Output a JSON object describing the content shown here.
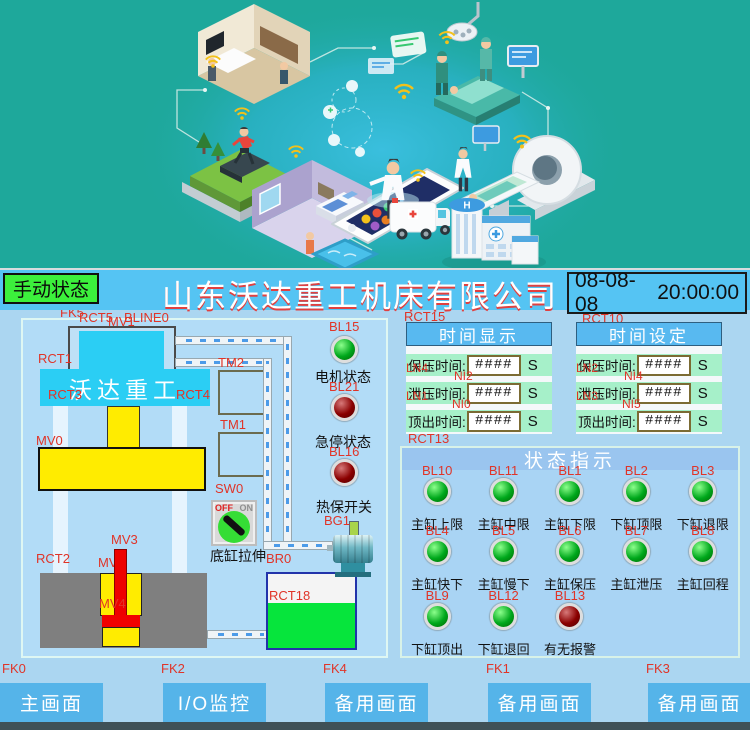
{
  "header": {
    "mode_button": "手动状态",
    "title": "山东沃达重工机床有限公司",
    "date": "08-08-08",
    "time": "20:00:00"
  },
  "illustration": {
    "helipad_letter": "H"
  },
  "machine": {
    "brand": "沃达重工",
    "switch_off": "OFF",
    "switch_on": "ON",
    "labels": {
      "motor_status": "电机状态",
      "estop_status": "急停状态",
      "thermal_switch": "热保开关",
      "bottom_cylinder": "底缸拉伸"
    },
    "leds": {
      "bl15": "green",
      "bl21": "red",
      "bl16": "red"
    },
    "tags": {
      "fk5": "FK5",
      "rct5": "RCT5",
      "mv1": "MV1",
      "bline0": "BLINE0",
      "rct1": "RCT1",
      "tm2": "TM2",
      "rct3": "RCT3",
      "rct4": "RCT4",
      "tm1": "TM1",
      "mv0": "MV0",
      "sw0": "SW0",
      "mv3": "MV3",
      "rct2": "RCT2",
      "mv2": "MV2",
      "mv4": "MV4",
      "br0": "BR0",
      "bg1": "BG1",
      "rct18": "RCT18",
      "bl15": "BL15",
      "bl21": "BL21",
      "bl16": "BL16",
      "rct15": "RCT15",
      "rct10": "RCT10"
    }
  },
  "time_display": {
    "title": "时间显示",
    "rows": [
      {
        "label": "保压时间:",
        "value": "####",
        "unit": "S",
        "tag_left": "LN4",
        "tag_bottom": "NI2"
      },
      {
        "label": "泄压时间:",
        "value": "####",
        "unit": "S",
        "tag_left": "LN1",
        "tag_bottom": "NI0"
      },
      {
        "label": "顶出时间:",
        "value": "####",
        "unit": "S",
        "tag_left": "",
        "tag_bottom": "RCT13"
      }
    ]
  },
  "time_setting": {
    "title": "时间设定",
    "rows": [
      {
        "label": "保压时间:",
        "value": "####",
        "unit": "S",
        "tag_left": "LN2",
        "tag_bottom": "NI4"
      },
      {
        "label": "泄压时间:",
        "value": "####",
        "unit": "S",
        "tag_left": "LN3",
        "tag_bottom": "NI5"
      },
      {
        "label": "顶出时间:",
        "value": "####",
        "unit": "S",
        "tag_left": "",
        "tag_bottom": ""
      }
    ]
  },
  "status": {
    "title": "状态指示",
    "rows": [
      {
        "cells": [
          {
            "tag": "BL10",
            "led": "green",
            "label": "主缸上限"
          },
          {
            "tag": "BL11",
            "led": "green",
            "label": "主缸中限"
          },
          {
            "tag": "BL1",
            "led": "green",
            "label": "主缸下限"
          },
          {
            "tag": "BL2",
            "led": "green",
            "label": "下缸顶限"
          },
          {
            "tag": "BL3",
            "led": "green",
            "label": "下缸退限"
          }
        ]
      },
      {
        "cells": [
          {
            "tag": "BL4",
            "led": "green",
            "label": "主缸快下"
          },
          {
            "tag": "BL5",
            "led": "green",
            "label": "主缸慢下"
          },
          {
            "tag": "BL6",
            "led": "green",
            "label": "主缸保压"
          },
          {
            "tag": "BL7",
            "led": "green",
            "label": "主缸泄压"
          },
          {
            "tag": "BL8",
            "led": "green",
            "label": "主缸回程"
          }
        ]
      },
      {
        "cells": [
          {
            "tag": "BL9",
            "led": "green",
            "label": "下缸顶出"
          },
          {
            "tag": "BL12",
            "led": "green",
            "label": "下缸退回"
          },
          {
            "tag": "BL13",
            "led": "red",
            "label": "有无报警"
          }
        ]
      }
    ]
  },
  "nav": {
    "buttons": [
      "主画面",
      "I/O监控",
      "备用画面",
      "备用画面",
      "备用画面"
    ],
    "tags": [
      "FK0",
      "FK2",
      "FK4",
      "FK1",
      "FK3"
    ]
  }
}
